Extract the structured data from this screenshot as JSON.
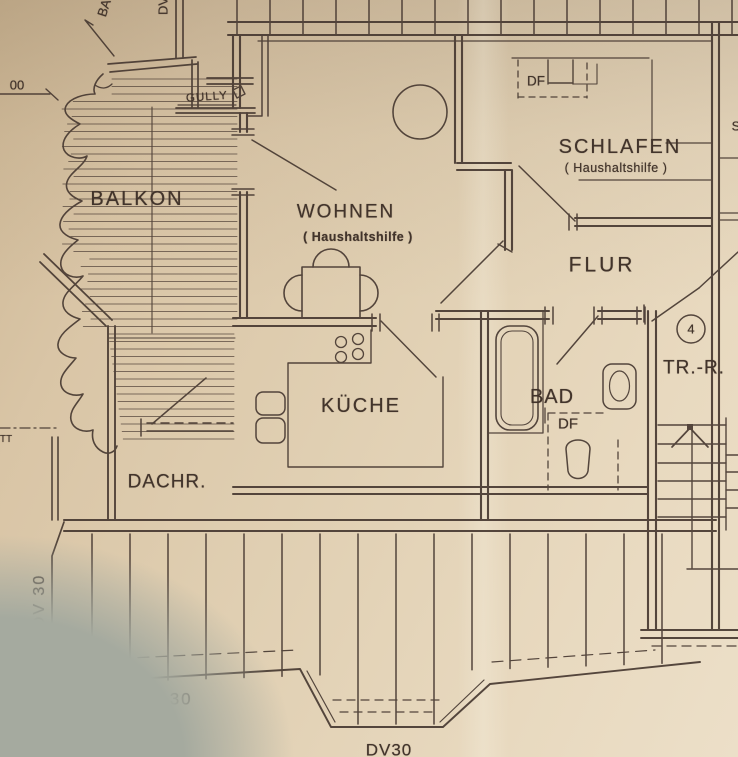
{
  "colors": {
    "paper": "#dcc9ac",
    "ink": "#473931",
    "table_surface": "#a5aa9f"
  },
  "rooms": {
    "balkon": {
      "label": "BALKON"
    },
    "wohnen": {
      "label": "WOHNEN",
      "sublabel": "( Haushaltshilfe )"
    },
    "schlafen": {
      "label": "SCHLAFEN",
      "sublabel": "( Haushaltshilfe )"
    },
    "flur": {
      "label": "FLUR"
    },
    "kueche": {
      "label": "KÜCHE"
    },
    "bad": {
      "label": "BAD"
    },
    "treppenraum": {
      "label": "TR.-R.",
      "number": "4"
    },
    "dachraum": {
      "label": "DACHR."
    }
  },
  "annotations": {
    "gully": "GULLY",
    "df_schlafen": "DF",
    "df_bad": "DF",
    "dv30_left": "DV 30",
    "dv30_bottom": "DV 30",
    "dv30_dormer": "DV30",
    "dim_left": "00",
    "edge_top_balkon": "BA",
    "edge_top_dv": "DV",
    "edge_right": "S",
    "edge_left": "TT"
  }
}
